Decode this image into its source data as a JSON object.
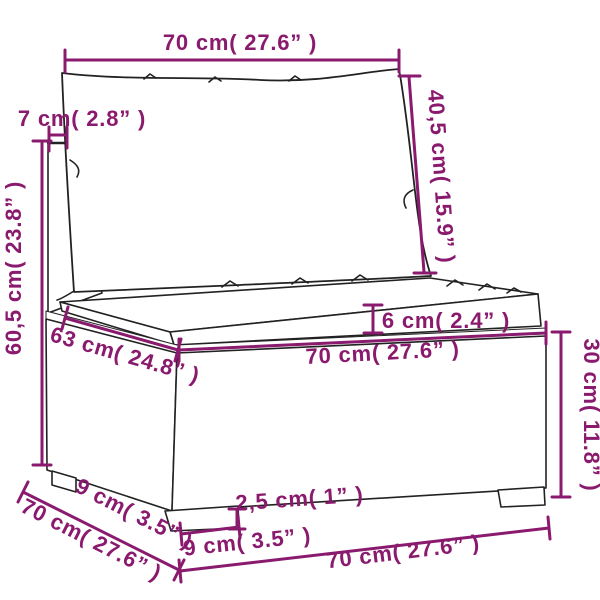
{
  "figure": {
    "kind": "product-dimension-diagram",
    "subject": "rattan sectional sofa middle section with back and seat cushions",
    "background_color": "#ffffff",
    "accent_color": "#8a1a6e",
    "art_line_color": "#222222"
  },
  "dimensions": {
    "top_width": "70 cm( 27.6” )",
    "back_panel_thickness": "7 cm( 2.8” )",
    "back_total_height": "60,5 cm( 23.8” )",
    "back_cushion_height": "40,5 cm( 15.9” )",
    "seat_depth_inner": "63 cm( 24.8” )",
    "seat_cushion_thickness": "6 cm( 2.4” )",
    "seat_front_width": "70 cm( 27.6” )",
    "base_height": "30 cm( 11.8” )",
    "foot_height": "2,5 cm( 1” )",
    "foot_width_front": "9 cm( 3.5” )",
    "foot_width_side": "9 cm( 3.5” )",
    "side_depth": "70 cm( 27.6” )",
    "bottom_front_width": "70 cm( 27.6” )"
  }
}
